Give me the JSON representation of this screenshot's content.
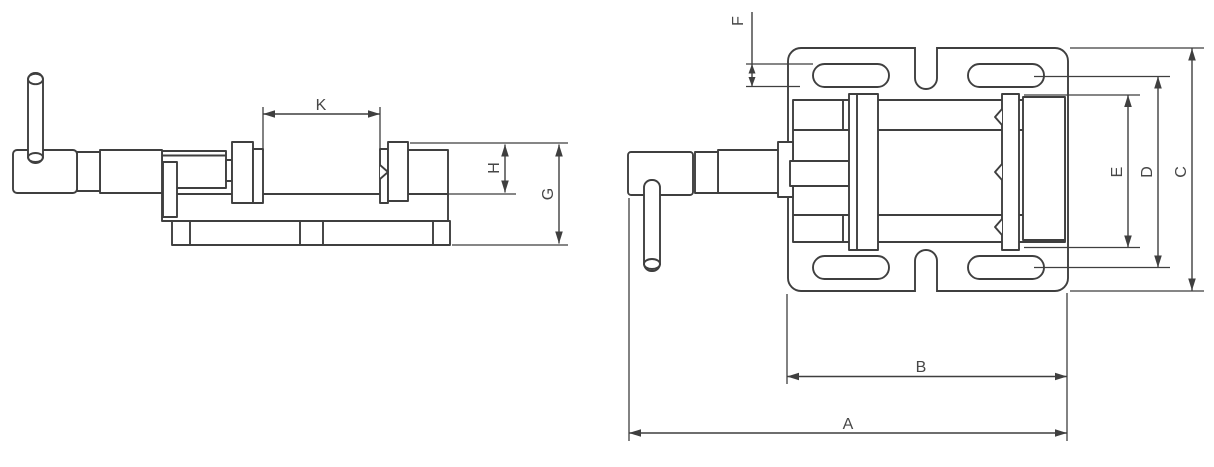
{
  "page": {
    "background": "#ffffff",
    "line_color": "#3f3f3f",
    "label_color": "#474747"
  },
  "views": {
    "side_view": {
      "dimension_labels": [
        "K",
        "H",
        "G"
      ]
    },
    "top_view": {
      "dimension_labels": [
        "F",
        "E",
        "D",
        "C",
        "B",
        "A"
      ]
    }
  },
  "labels": {
    "A": "A",
    "B": "B",
    "C": "C",
    "D": "D",
    "E": "E",
    "F": "F",
    "G": "G",
    "H": "H",
    "K": "K"
  }
}
